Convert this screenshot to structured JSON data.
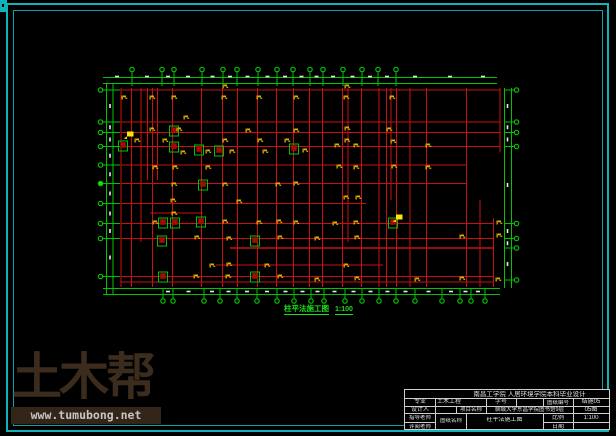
{
  "caption": {
    "text": "柱平法施工图",
    "scale": "1:100"
  },
  "watermark": {
    "brand": "土木帮",
    "url": "www.tumubong.net"
  },
  "title_block": {
    "header": "南昌工学院 人居环境学院本科毕业设计",
    "major_label": "专业",
    "major_value": "土木工程",
    "student_id_label": "学号",
    "student_id_value": "",
    "drawing_no_label": "图纸编号",
    "drawing_no_value": "结施05",
    "designer_label": "设计人",
    "project_label": "项目名称",
    "project_value": "聊城大学东昌学院图书馆9层",
    "sheet_no_value": "05图",
    "advisor_label": "指导老师",
    "sheet_name_label": "图纸名称",
    "sheet_name_value": "柱平法施工图",
    "scale_label": "比例",
    "scale_value": "1:100",
    "reviewer_label": "评阅老师",
    "date_label": "日期",
    "date_value": ""
  },
  "colors": {
    "teal": "#12b2ba",
    "grid_red": "#c91111",
    "dim_green": "#00c400",
    "bright_green": "#1ae01a",
    "tag_yellow": "#e2ae00",
    "highlight_yellow": "#ffe600",
    "column_red": "#a30b0b",
    "dash_white": "#e8e8e8"
  },
  "plan": {
    "grid_h": [
      [
        90,
        121,
        500
      ],
      [
        122,
        121,
        500
      ],
      [
        132.5,
        121,
        500
      ],
      [
        146.5,
        121,
        500
      ],
      [
        165,
        121,
        466
      ],
      [
        183.5,
        121,
        466
      ],
      [
        203.5,
        121,
        366
      ],
      [
        213,
        150,
        203
      ],
      [
        223.5,
        121,
        494
      ],
      [
        238.5,
        121,
        494
      ],
      [
        248,
        230,
        494
      ],
      [
        265,
        216,
        383
      ],
      [
        276.5,
        121,
        494
      ],
      [
        282,
        121,
        494
      ]
    ],
    "grid_v": [
      [
        121,
        88,
        287
      ],
      [
        131.5,
        88,
        287
      ],
      [
        141,
        88,
        242
      ],
      [
        147.5,
        88,
        180
      ],
      [
        152.5,
        88,
        287
      ],
      [
        157.5,
        88,
        180
      ],
      [
        172.5,
        88,
        287
      ],
      [
        201.5,
        88,
        287
      ],
      [
        222.5,
        88,
        287
      ],
      [
        237.5,
        88,
        287
      ],
      [
        257.5,
        88,
        287
      ],
      [
        276.5,
        88,
        287
      ],
      [
        293.5,
        88,
        287
      ],
      [
        309.5,
        88,
        287
      ],
      [
        322.5,
        88,
        287
      ],
      [
        342.5,
        88,
        287
      ],
      [
        348,
        88,
        242
      ],
      [
        361.5,
        88,
        287
      ],
      [
        379,
        88,
        287
      ],
      [
        386.5,
        88,
        287
      ],
      [
        391,
        88,
        200
      ],
      [
        396.5,
        88,
        287
      ],
      [
        410,
        88,
        287
      ],
      [
        426.5,
        88,
        287
      ],
      [
        466.5,
        88,
        287
      ],
      [
        480,
        200,
        287
      ],
      [
        493.5,
        218,
        287
      ],
      [
        500,
        88,
        152
      ]
    ],
    "dims": {
      "top": {
        "lines": [
          77.5,
          83.5
        ],
        "x1": 103,
        "x2": 497
      },
      "bottom": {
        "lines": [
          288.5,
          294.5
        ],
        "x1": 103,
        "x2": 500
      },
      "left": {
        "lines": [
          106.5,
          113
        ],
        "y1": 83.5,
        "y2": 294.5
      },
      "right": {
        "lines": [
          504.5,
          511.5
        ],
        "y1": 88,
        "y2": 288
      }
    },
    "bubbles": {
      "top": {
        "cy": 69.5,
        "tick": [
          72,
          86
        ],
        "x": [
          132,
          162,
          174,
          202,
          223,
          237,
          258,
          277,
          293,
          310,
          323,
          343,
          362,
          378,
          396
        ]
      },
      "bottom": {
        "cy": 301,
        "tick": [
          288,
          298.5
        ],
        "x": [
          163,
          173,
          204,
          220,
          237,
          257,
          277,
          294,
          311,
          324,
          345,
          362,
          379,
          396,
          415,
          442,
          460,
          471,
          485
        ]
      },
      "left": {
        "cx": 100.5,
        "tick": [
          103,
          120
        ],
        "y": [
          90,
          122,
          132.5,
          146.5,
          165,
          183.5,
          203.5,
          223.5,
          238.5,
          276.5
        ],
        "filled_y": 183.5
      },
      "right": {
        "cx": 516.5,
        "tick": [
          504.5,
          514
        ],
        "y": [
          90,
          122,
          132.5,
          146.5,
          223.5,
          238.5,
          248,
          280
        ]
      }
    },
    "extra_top_dashes": [
      117,
      415,
      450,
      483
    ],
    "columns": [
      [
        123,
        145
      ],
      [
        174,
        130
      ],
      [
        174,
        146
      ],
      [
        199,
        149
      ],
      [
        219,
        150
      ],
      [
        294,
        148
      ],
      [
        203,
        184
      ],
      [
        163,
        222
      ],
      [
        175,
        222
      ],
      [
        201,
        221
      ],
      [
        162,
        240
      ],
      [
        255,
        240
      ],
      [
        163,
        276
      ],
      [
        255,
        276
      ],
      [
        393,
        222
      ]
    ],
    "tags": [
      [
        223,
        86
      ],
      [
        345,
        86
      ],
      [
        122,
        97
      ],
      [
        150,
        97
      ],
      [
        172,
        97
      ],
      [
        222,
        97
      ],
      [
        257,
        97
      ],
      [
        294,
        97
      ],
      [
        344,
        97
      ],
      [
        390,
        97
      ],
      [
        184,
        117
      ],
      [
        150,
        129
      ],
      [
        177,
        129
      ],
      [
        246,
        130
      ],
      [
        294,
        130
      ],
      [
        345,
        128
      ],
      [
        387,
        129
      ],
      [
        135,
        140
      ],
      [
        163,
        140
      ],
      [
        223,
        140
      ],
      [
        258,
        140
      ],
      [
        285,
        140
      ],
      [
        345,
        140
      ],
      [
        391,
        141
      ],
      [
        335,
        145
      ],
      [
        354,
        145
      ],
      [
        426,
        145
      ],
      [
        181,
        152
      ],
      [
        206,
        151
      ],
      [
        230,
        151
      ],
      [
        263,
        151
      ],
      [
        303,
        150
      ],
      [
        153,
        167
      ],
      [
        173,
        167
      ],
      [
        206,
        167
      ],
      [
        337,
        166
      ],
      [
        354,
        167
      ],
      [
        392,
        166
      ],
      [
        426,
        167
      ],
      [
        172,
        184
      ],
      [
        223,
        184
      ],
      [
        276,
        184
      ],
      [
        294,
        183
      ],
      [
        344,
        197
      ],
      [
        356,
        197
      ],
      [
        171,
        200
      ],
      [
        237,
        201
      ],
      [
        172,
        213
      ],
      [
        153,
        222
      ],
      [
        223,
        221
      ],
      [
        257,
        222
      ],
      [
        277,
        221
      ],
      [
        294,
        222
      ],
      [
        333,
        223
      ],
      [
        354,
        222
      ],
      [
        497,
        222
      ],
      [
        195,
        237
      ],
      [
        227,
        238
      ],
      [
        278,
        237
      ],
      [
        315,
        238
      ],
      [
        355,
        237
      ],
      [
        460,
        236
      ],
      [
        497,
        235
      ],
      [
        210,
        265
      ],
      [
        227,
        264
      ],
      [
        265,
        265
      ],
      [
        344,
        265
      ],
      [
        194,
        276
      ],
      [
        226,
        276
      ],
      [
        278,
        276
      ],
      [
        315,
        279
      ],
      [
        355,
        278
      ],
      [
        415,
        279
      ],
      [
        460,
        278
      ],
      [
        496,
        279
      ]
    ],
    "highlights": [
      [
        128,
        134
      ],
      [
        397,
        217
      ]
    ]
  }
}
